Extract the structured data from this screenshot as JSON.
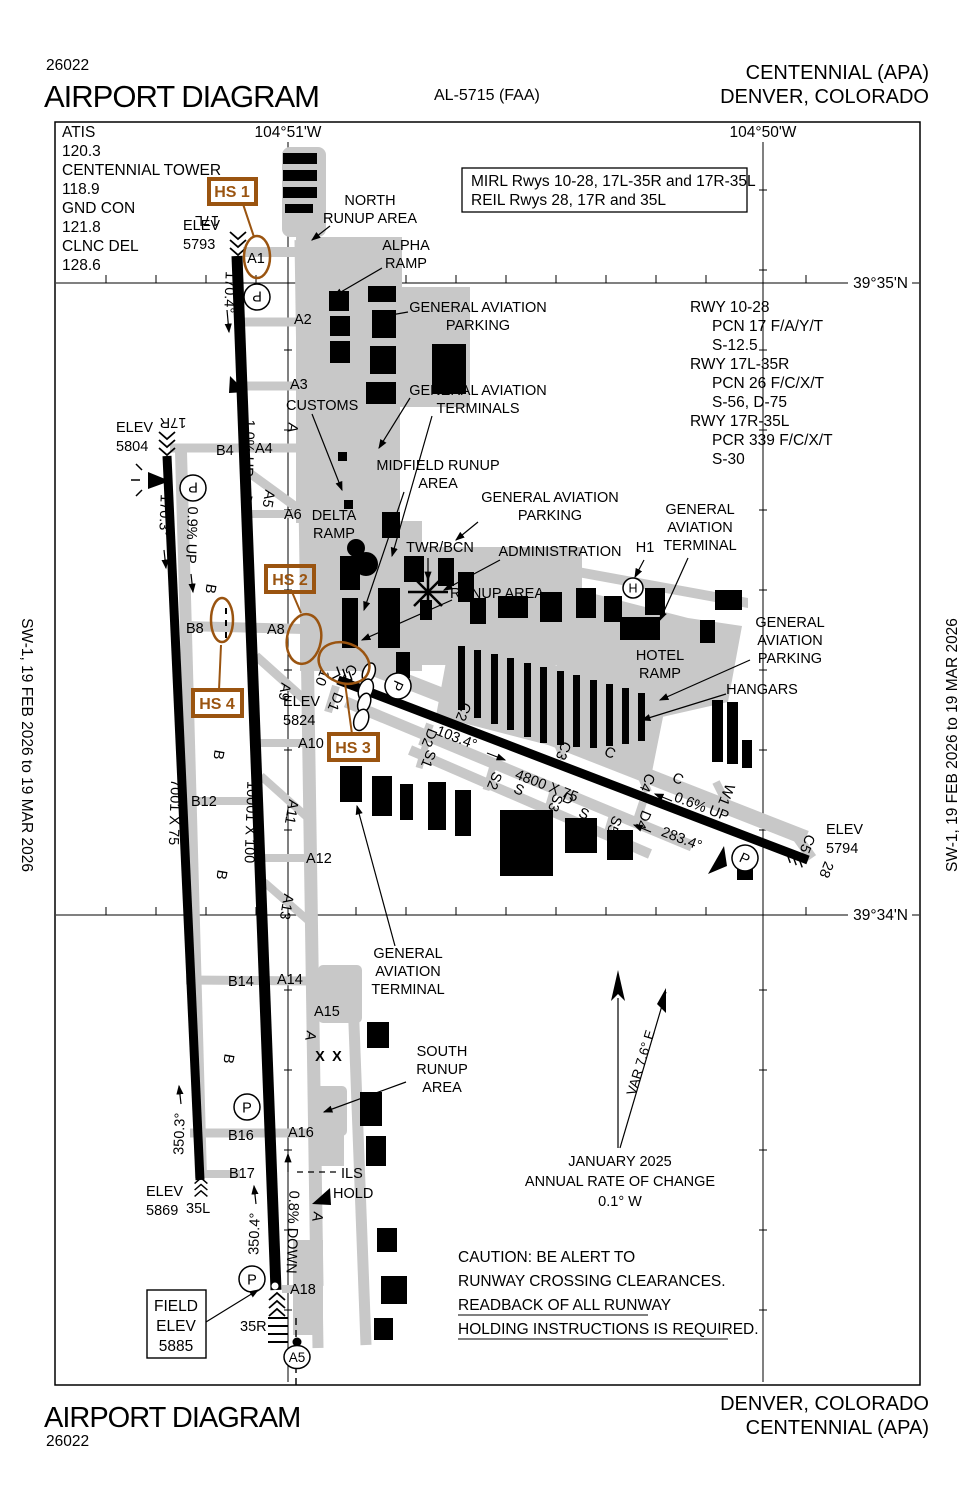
{
  "header": {
    "code": "26022",
    "title": "AIRPORT DIAGRAM",
    "al": "AL-5715 (FAA)",
    "airport": "CENTENNIAL (APA)",
    "city": "DENVER, COLORADO"
  },
  "footer": {
    "title": "AIRPORT DIAGRAM",
    "code": "26022",
    "city": "DENVER, COLORADO",
    "airport": "CENTENNIAL (APA)"
  },
  "edge_note": "SW-1,  19 FEB 2026  to  19 MAR 2026",
  "frequencies": {
    "lines": [
      "ATIS",
      "120.3",
      "CENTENNIAL TOWER",
      "118.9",
      "GND CON",
      "121.8",
      "CLNC DEL",
      "128.6"
    ]
  },
  "lighting": {
    "line1": "MIRL Rwys 10-28, 17L-35R and 17R-35L",
    "line2": "REIL Rwys 28, 17R and 35L"
  },
  "runway_data": {
    "r1": "RWY 10-28",
    "r1_pcn": "PCN 17 F/A/Y/T",
    "r1_s": "S-12.5",
    "r2": "RWY 17L-35R",
    "r2_pcn": "PCN 26 F/C/X/T",
    "r2_s": "S-56, D-75",
    "r3": "RWY 17R-35L",
    "r3_pcn": "PCR 339 F/C/X/T",
    "r3_s": "S-30"
  },
  "coordinates": {
    "lon_51": "104°51'W",
    "lon_50": "104°50'W",
    "lat_35": "39°35'N",
    "lat_34": "39°34'N"
  },
  "hotspots": {
    "hs1": "HS 1",
    "hs2": "HS 2",
    "hs3": "HS 3",
    "hs4": "HS 4"
  },
  "runways": {
    "r17l": {
      "id": "17L",
      "elev_label": "ELEV",
      "elev": "5793",
      "hdg": "170.4°",
      "slope": "1.0% UP"
    },
    "r35r": {
      "id": "35R",
      "hdg": "350.4°",
      "slope": "0.8% DOWN"
    },
    "r17l35r_dim": "10001 X 100",
    "r17r": {
      "id": "17R",
      "elev_label": "ELEV",
      "elev": "5804",
      "hdg": "170.3°",
      "slope": "0.9% UP"
    },
    "r35l": {
      "id": "35L",
      "elev_label": "ELEV",
      "elev": "5869",
      "hdg": "350.3°"
    },
    "r17r35l_dim": "7001 X 75",
    "r10": {
      "id": "10",
      "elev_label": "ELEV",
      "elev": "5824",
      "hdg": "103.4°"
    },
    "r28": {
      "id": "28",
      "elev_label": "ELEV",
      "elev": "5794",
      "hdg": "283.4°",
      "slope": "0.6% UP"
    },
    "r1028_dim": "4800 X 75"
  },
  "field_elev": {
    "line1": "FIELD",
    "line2": "ELEV",
    "line3": "5885"
  },
  "labels": {
    "north_runup1": "NORTH",
    "north_runup2": "RUNUP AREA",
    "alpha1": "ALPHA",
    "alpha2": "RAMP",
    "gap_n1": "GENERAL AVIATION",
    "gap_n2": "PARKING",
    "gat_n1": "GENERAL AVIATION",
    "gat_n2": "TERMINALS",
    "customs": "CUSTOMS",
    "midfield1": "MIDFIELD RUNUP",
    "midfield2": "AREA",
    "delta1": "DELTA",
    "delta2": "RAMP",
    "gap_m1": "GENERAL AVIATION",
    "gap_m2": "PARKING",
    "twr": "TWR/BCN",
    "admin": "ADMINISTRATION",
    "gat_r1": "GENERAL",
    "gat_r2": "AVIATION",
    "gat_r3": "TERMINAL",
    "h1": "H1",
    "runup": "RUNUP AREA",
    "hotel1": "HOTEL",
    "hotel2": "RAMP",
    "gap_r1": "GENERAL",
    "gap_r2": "AVIATION",
    "gap_r3": "PARKING",
    "hangars": "HANGARS",
    "gat_b1": "GENERAL",
    "gat_b2": "AVIATION",
    "gat_b3": "TERMINAL",
    "south1": "SOUTH",
    "south2": "RUNUP",
    "south3": "AREA"
  },
  "taxiways": {
    "a": "A",
    "a1": "A1",
    "a2": "A2",
    "a3": "A3",
    "a4": "A4",
    "a5": "A5",
    "a6": "A6",
    "a8": "A8",
    "a9": "A9",
    "a10": "A10",
    "a11": "A11",
    "a12": "A12",
    "a13": "A13",
    "a14": "A14",
    "a15": "A15",
    "a16": "A16",
    "a18": "A18",
    "a5_circle": "A5",
    "b": "B",
    "b4": "B4",
    "b8": "B8",
    "b12": "B12",
    "b14": "B14",
    "b16": "B16",
    "b17": "B17",
    "c": "C",
    "c1": "C1",
    "c2": "C2",
    "c3": "C3",
    "c4": "C4",
    "c5": "C5",
    "d": "D",
    "d1": "D1",
    "d2": "D2",
    "d4": "D4",
    "s": "S",
    "s1": "S1",
    "s2": "S2",
    "s3": "S3",
    "s5": "S5",
    "w1": "W1",
    "h": "H",
    "p": "P",
    "x": "X"
  },
  "notes": {
    "var": "VAR 7.6° E",
    "date": "JANUARY 2025",
    "rate": "ANNUAL RATE OF CHANGE",
    "change": "0.1° W",
    "caution1": "CAUTION: BE ALERT TO",
    "caution2": "RUNWAY CROSSING CLEARANCES.",
    "caution3": "READBACK OF ALL RUNWAY",
    "caution4": "HOLDING INSTRUCTIONS IS REQUIRED.",
    "ils": "ILS",
    "hold": "HOLD"
  },
  "colors": {
    "hotspot": "#9A5410",
    "apron": "#C8C8C8"
  }
}
